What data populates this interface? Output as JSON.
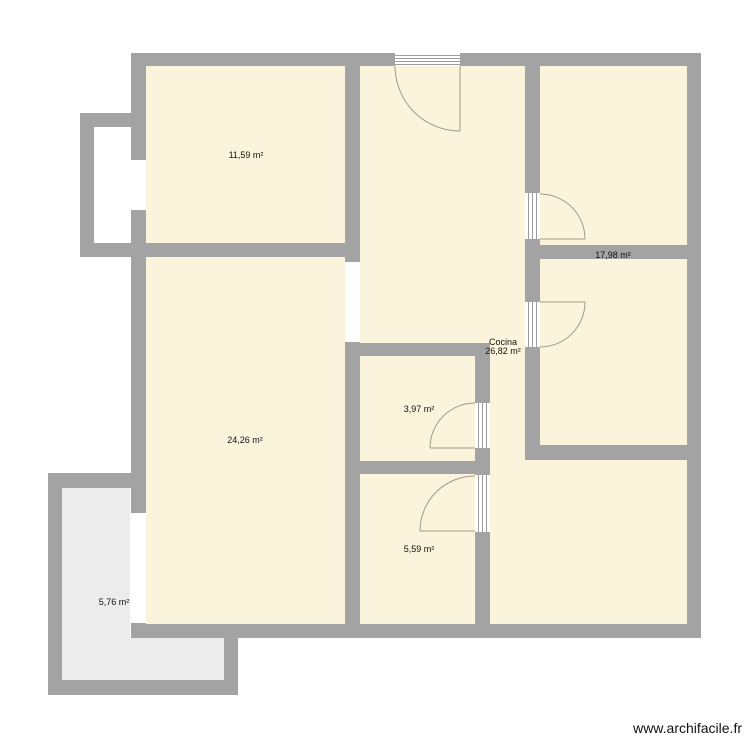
{
  "app": {
    "watermark": "www.archifacile.fr"
  },
  "plan": {
    "units": "m²",
    "rooms": [
      {
        "id": "room-11-59",
        "name": "",
        "area": "11,59 m²"
      },
      {
        "id": "room-17-98",
        "name": "",
        "area": "17,98 m²"
      },
      {
        "id": "room-cocina",
        "name": "Cocina",
        "area": "26,82 m²"
      },
      {
        "id": "room-3-97",
        "name": "",
        "area": "3,97 m²"
      },
      {
        "id": "room-24-26",
        "name": "",
        "area": "24,26 m²"
      },
      {
        "id": "room-5-59",
        "name": "",
        "area": "5,59 m²"
      },
      {
        "id": "room-5-76",
        "name": "",
        "area": "5,76 m²"
      }
    ],
    "colors": {
      "wall": "#a3a3a3",
      "room_fill": "#fbf4dd",
      "outdoor_fill": "#ececec",
      "opening_fill": "#ffffff",
      "door_arc": "#a09a8c",
      "label_text": "#111111"
    },
    "door_count": 5,
    "window_count": 3
  }
}
